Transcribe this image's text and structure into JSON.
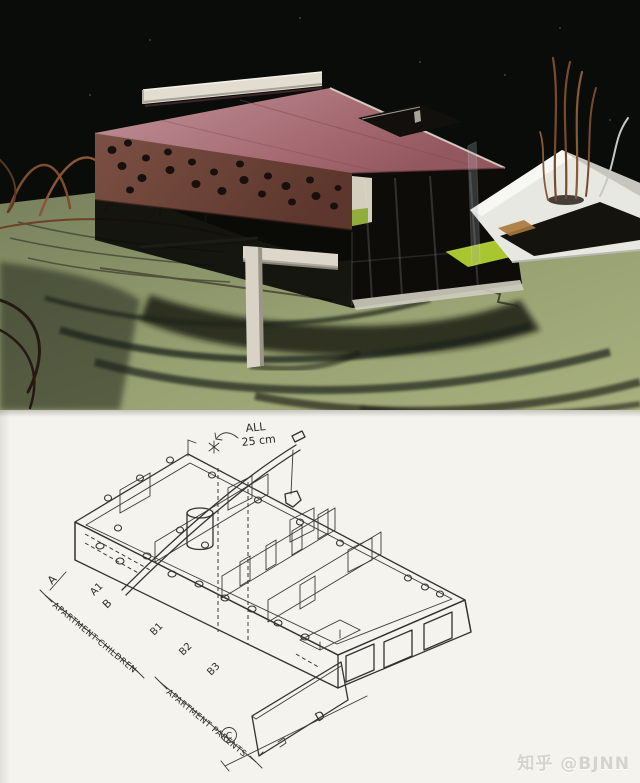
{
  "photo": {
    "subject": "architecture-model-photo",
    "colors": {
      "night_background": "#0a0c09",
      "terrain_green": "#9aa274",
      "roof_pink": "#b2848a",
      "perforated_wall_brown": "#6f463c",
      "lime_panel": "#a9c52f",
      "structure_white": "#e2ddd0",
      "copper_wire": "#8a5636"
    }
  },
  "drawing": {
    "note_line1": "ALL",
    "note_line2": "25 cm",
    "markers": [
      "A",
      "A1",
      "B",
      "B1",
      "B2",
      "B3",
      "C",
      "D"
    ],
    "label_children": "APARTMENT-CHILDREN",
    "label_parents": "APARTMENT PARENTS",
    "ink": "#323230",
    "paper": "#f5f3ee"
  },
  "watermark": {
    "text": "知乎 @BJNN",
    "color": "#d5d3ce"
  }
}
